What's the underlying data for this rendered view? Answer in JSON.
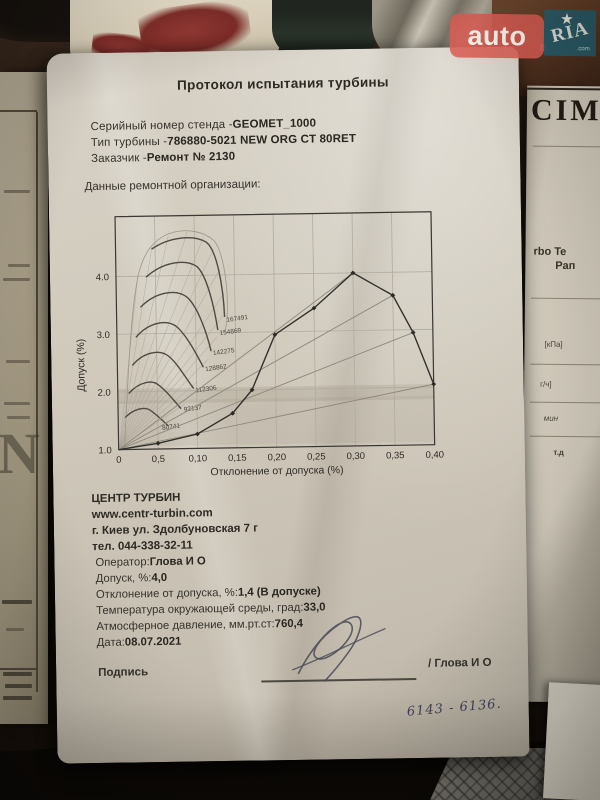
{
  "watermark": {
    "auto_label": "auto",
    "ria_label": "RIA",
    "domain_label": ".com"
  },
  "document": {
    "title": "Протокол испытания турбины",
    "fields": [
      {
        "label": "Серийный номер стенда - ",
        "value": "GEOMET_1000"
      },
      {
        "label": "Тип турбины - ",
        "value": "786880-5021 NEW ORG CT 80RET"
      },
      {
        "label": "Заказчик - ",
        "value": "Ремонт № 2130"
      }
    ],
    "section_heading": "Данные ремонтной организации:",
    "org_lines": [
      "ЦЕНТР ТУРБИН",
      "www.centr-turbin.com",
      "г. Киев ул. Здолбуновская 7 г",
      "тел. 044-338-32-11"
    ],
    "results": [
      {
        "label": "Оператор: ",
        "value": "Глова И О"
      },
      {
        "label": "Допуск, %: ",
        "value": "4,0"
      },
      {
        "label": "Отклонение от допуска, %: ",
        "value": "1,4 (В допуске)"
      },
      {
        "label": "Температура окружающей среды, град: ",
        "value": "33,0"
      },
      {
        "label": "Атмосферное давление, мм.рт.ст: ",
        "value": "760,4"
      },
      {
        "label": "Дата: ",
        "value": "08.07.2021"
      }
    ],
    "signature_label": "Подпись",
    "signature_name": "/  Глова И О",
    "handwritten_note": "6143 - 6136."
  },
  "background_papers": {
    "left_watermark_letter": "N",
    "right_fragments": [
      "CIM",
      "rbo Te",
      "Рап",
      "[кПа]",
      "г/ч]",
      "мин",
      "т.д"
    ]
  },
  "chart_data": {
    "type": "line",
    "title": "",
    "xlabel": "Отклонение от допуска (%)",
    "ylabel": "Допуск (%)",
    "x_ticks": [
      "0",
      "0,5",
      "0,10",
      "0,15",
      "0,20",
      "0,25",
      "0,30",
      "0,35",
      "0,40"
    ],
    "x_tick_values": [
      0,
      0.05,
      0.1,
      0.15,
      0.2,
      0.25,
      0.3,
      0.35,
      0.4
    ],
    "y_ticks": [
      "1.0",
      "2.0",
      "3.0",
      "4.0"
    ],
    "y_tick_values": [
      1.0,
      2.0,
      3.0,
      4.0
    ],
    "xlim": [
      0,
      0.4
    ],
    "ylim": [
      1.0,
      5.0
    ],
    "grid": true,
    "legend": false,
    "series": [
      {
        "name": "main-curve",
        "x": [
          0,
          0.05,
          0.1,
          0.145,
          0.17,
          0.2,
          0.25,
          0.3,
          0.35,
          0.375,
          0.4
        ],
        "y": [
          1.0,
          1.1,
          1.25,
          1.6,
          2.0,
          2.95,
          3.4,
          4.0,
          3.6,
          2.95,
          2.05
        ]
      }
    ],
    "speed_line_labels": [
      "167491",
      "154869",
      "142275",
      "128862",
      "112306",
      "92137",
      "80741"
    ]
  }
}
